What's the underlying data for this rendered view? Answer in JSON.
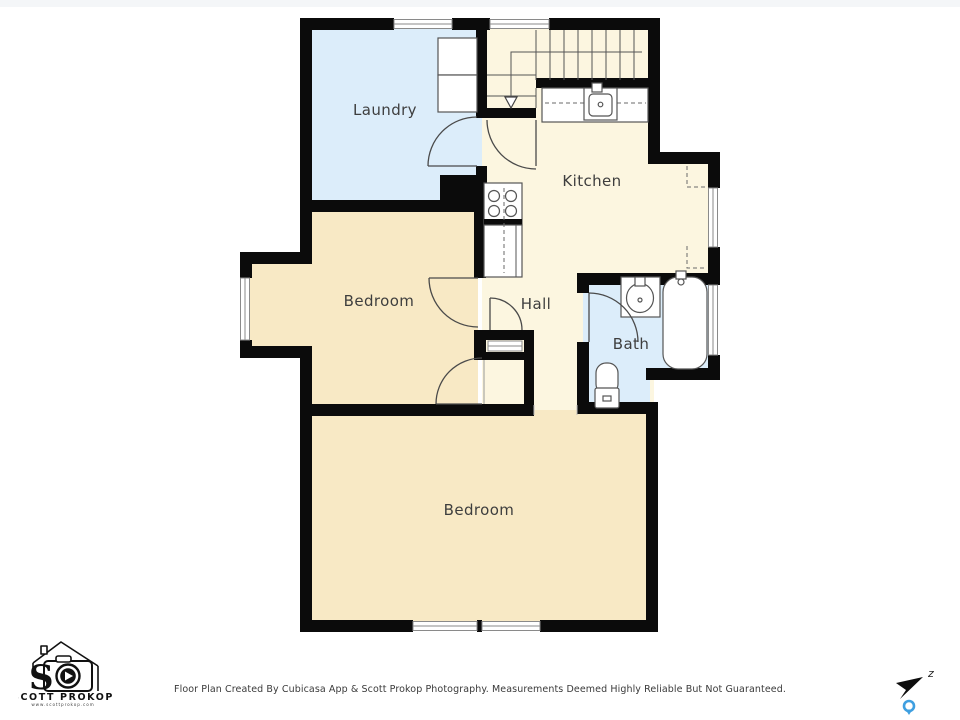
{
  "rooms": {
    "laundry": {
      "label": "Laundry"
    },
    "kitchen": {
      "label": "Kitchen"
    },
    "bedroom1": {
      "label": "Bedroom"
    },
    "hall": {
      "label": "Hall"
    },
    "bath": {
      "label": "Bath"
    },
    "bedroom2": {
      "label": "Bedroom"
    }
  },
  "footer": {
    "disclaimer": "Floor Plan Created By Cubicasa App & Scott Prokop Photography. Measurements Deemed Highly Reliable But Not Guaranteed."
  },
  "logo": {
    "monogram": "S",
    "name": "SCOTT PROKOP",
    "website": "www.scottprokop.com"
  },
  "compass": {
    "north_label": "z"
  },
  "colors": {
    "wall": "#0b0b0b",
    "bedroom_fill": "#f8e9c5",
    "kitchen_fill": "#fcf6e0",
    "wet_room_fill": "#dcedfa",
    "pin_blue": "#3f9fe0"
  }
}
